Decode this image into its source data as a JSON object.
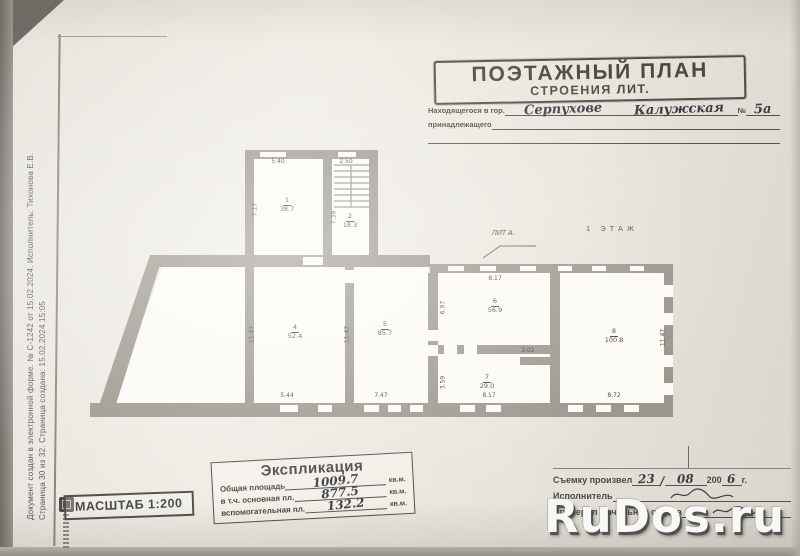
{
  "edoc": {
    "line1": "Документ создан в электронной форме. № С-1242 от 15.02.2024. Исполнитель: Тихонова Е.В.",
    "line2": "Страница 30 из 32. Страница создана: 15.02.2024 15:05"
  },
  "header": {
    "title": "ПОЭТАЖНЫЙ ПЛАН",
    "subtitle": "СТРОЕНИЯ ЛИТ.",
    "located_label": "Находящегося в гор.",
    "city": "Серпухове",
    "street": "Калужская",
    "number_sign": "№",
    "number": "5а",
    "owner_label": "принадлежащего"
  },
  "plan": {
    "floor_label": "1 ЭТАЖ",
    "lit_label": "ЛИТ А.",
    "rooms": [
      {
        "num": "1",
        "area": "38.7"
      },
      {
        "num": "2",
        "area": "18.3"
      },
      {
        "num": "4",
        "area": "52.4"
      },
      {
        "num": "5",
        "area": "85.7"
      },
      {
        "num": "6",
        "area": "56.9"
      },
      {
        "num": "7",
        "area": "29.0"
      },
      {
        "num": "8",
        "area": "100.8"
      }
    ],
    "dims": {
      "room1_top": "5.40",
      "room2_top": "2.50",
      "room1_left": "7.17",
      "room2_left": "7.39",
      "room4_left": "11.47",
      "room4_right": "11.47",
      "room8_right": "11.47",
      "room6_top": "8.17",
      "room6_left": "6.97",
      "room7_left": "3.59",
      "room7_step": "2.02",
      "room4_bottom": "5.44",
      "room5_bottom": "7.47",
      "room7_bottom": "8.17",
      "room8_bottom": "8.72"
    }
  },
  "scale_stamp": {
    "text": "МАСШТАБ 1:200"
  },
  "explication": {
    "title": "Экспликация",
    "rows": [
      {
        "label": "Общая площадь",
        "value": "1009.7",
        "unit": "кв.м."
      },
      {
        "label": "в т.ч. основная пл.",
        "value": "877.5",
        "unit": "кв.м."
      },
      {
        "label": "вспомогательная пл.",
        "value": "132.2",
        "unit": "кв.м."
      }
    ]
  },
  "survey": {
    "produced_label": "Съемку произвел",
    "day": "23",
    "date_sep": "/",
    "month": "08",
    "year_prefix": "200",
    "year_digit": "6",
    "year_suffix": "г.",
    "executor_label": "Исполнитель",
    "checked_label": "Проверил Начальник отдела"
  },
  "watermark": {
    "text": "RuDos.ru"
  }
}
